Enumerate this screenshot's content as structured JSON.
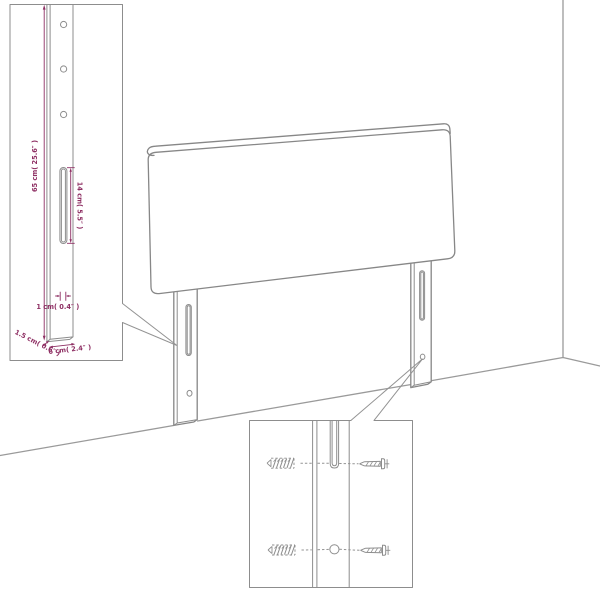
{
  "page": {
    "background": "#ffffff"
  },
  "colors": {
    "drawing_line": "#878787",
    "room_line": "#9a9a9a",
    "dimension": "#8e2f63"
  },
  "leg_detail_inset": {
    "dim_height": "65 cm( 25.6″ )",
    "dim_slot_length": "14 cm( 5.5″ )",
    "dim_slot_width": "1 cm( 0.4″ )",
    "dim_leg_depth": "1.5 cm( 0.6″ )",
    "dim_leg_width": "6 cm( 2.4″ )",
    "screw_holes_visible": 3
  },
  "mounting_inset": {
    "wall_plugs_visible": 2,
    "screws_visible": 2
  }
}
